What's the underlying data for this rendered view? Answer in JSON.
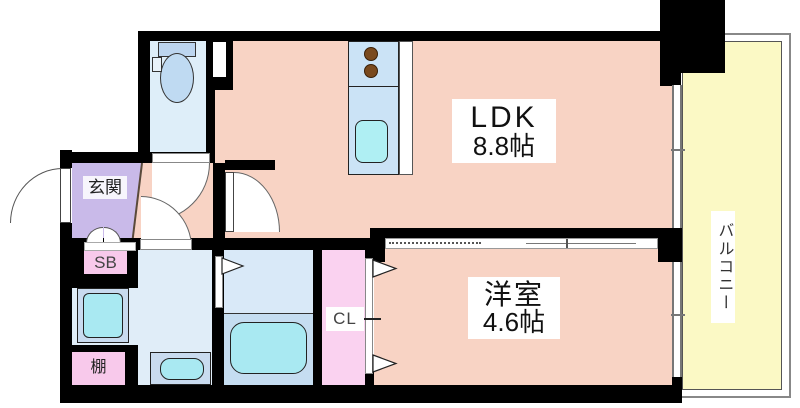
{
  "title": "1K apartment floor plan",
  "rooms": {
    "ldk": {
      "name": "LDK",
      "area": "8.8帖"
    },
    "yoshitsu": {
      "name": "洋室",
      "area": "4.6帖"
    },
    "balcony": {
      "name": "バルコニー"
    },
    "genkan": {
      "name": "玄関"
    }
  },
  "storage": {
    "shoe_box": "SB",
    "closet": "CL",
    "shelf": "棚"
  },
  "colors": {
    "floor_pink": "#F8D3C4",
    "balcony_yellow": "#FBF9C5",
    "water_blue": "#DEEEF9",
    "bath_blue": "#D9E9F8",
    "tub_zone_blue": "#C5DDF1",
    "counter_blue": "#CBE3F6",
    "appliance_blue": "#C9DBEF",
    "fixture_cyan": "#A9E9F2",
    "closet_pink": "#FAD2F0",
    "storage_pink": "#F8C9EB",
    "genkan_purple": "#C9BAE9",
    "burner_brown": "#7A4A1E",
    "wall_black": "#000000"
  }
}
